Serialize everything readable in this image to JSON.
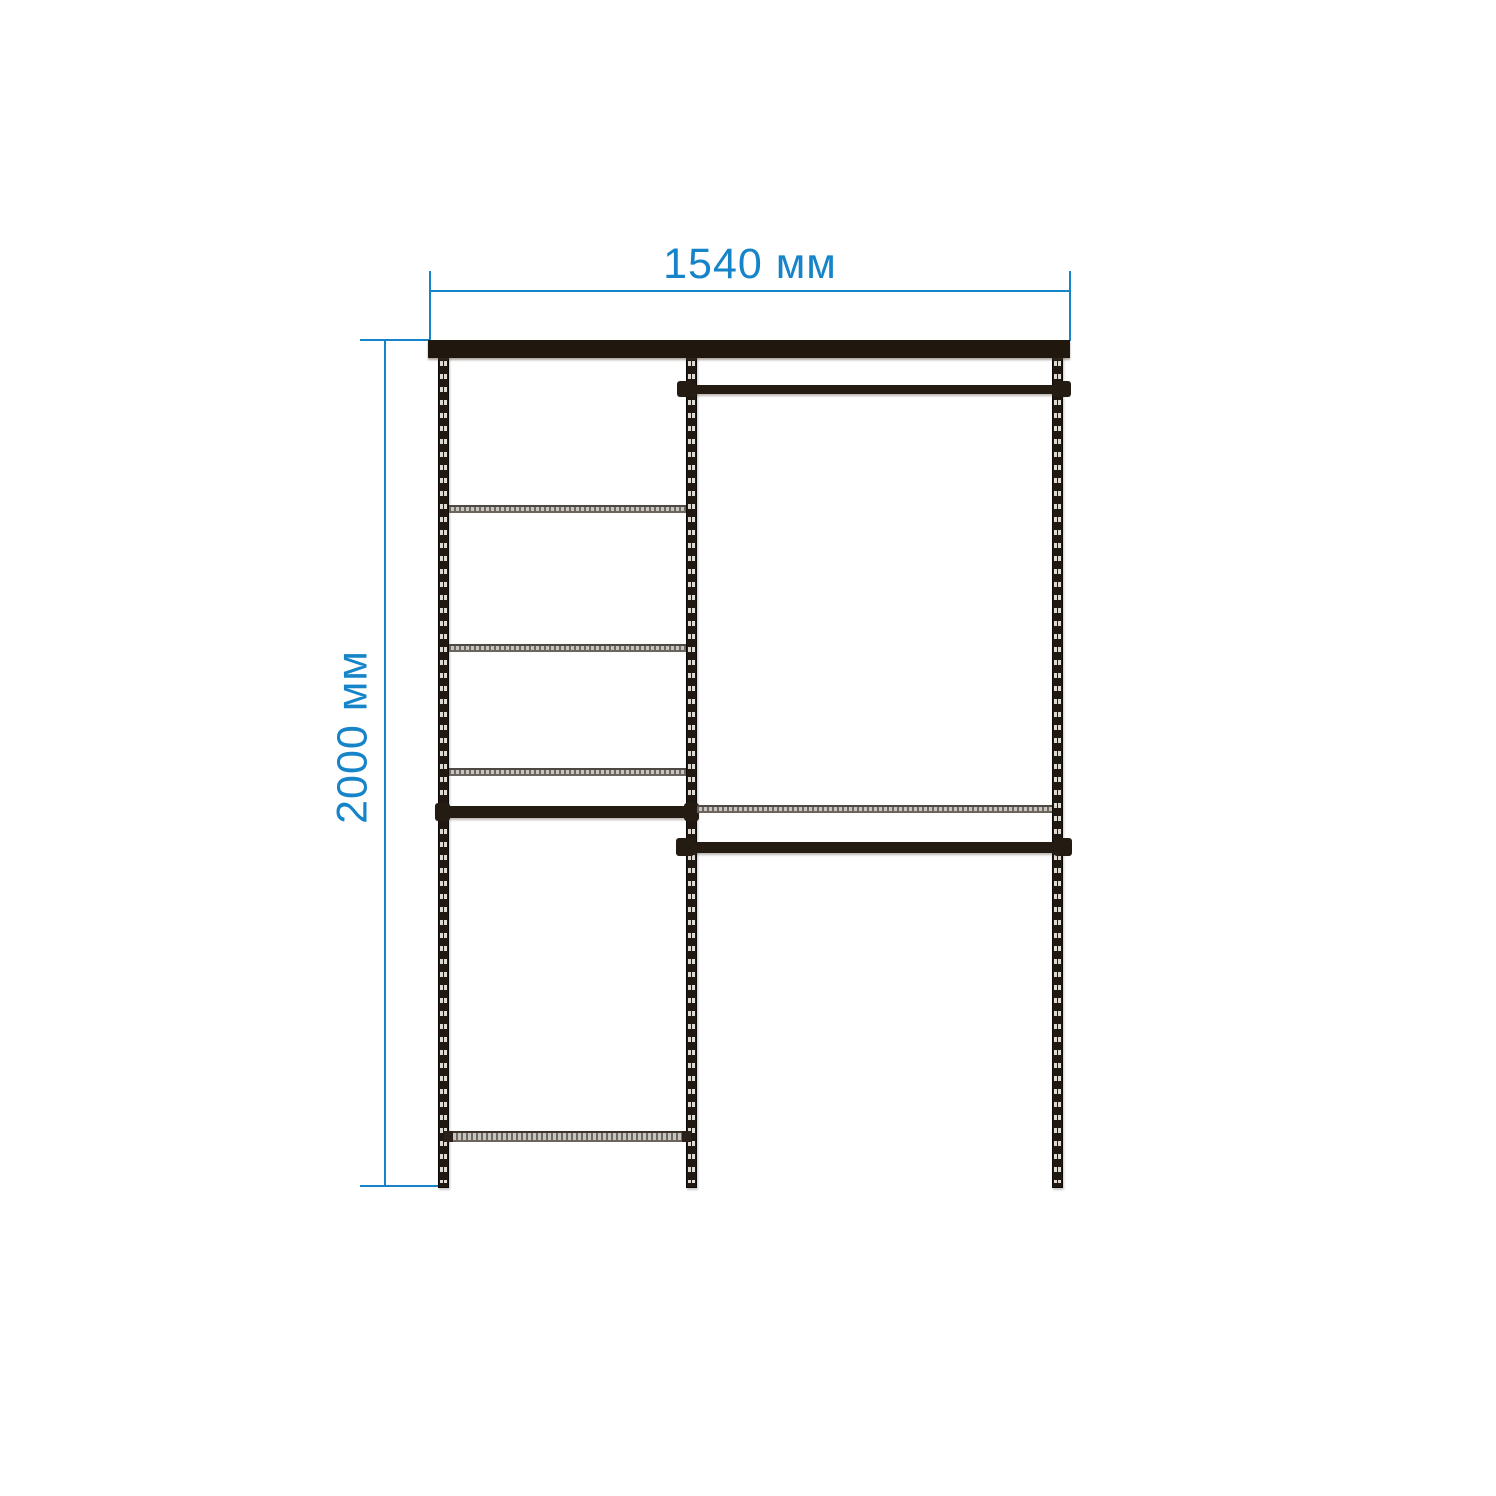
{
  "dimensions": {
    "width": {
      "label": "1540 мм"
    },
    "height": {
      "label": "2000 мм"
    }
  },
  "colors": {
    "dimension_blue": "#1684c9",
    "frame_dark": "#20180f",
    "shelf_grey": "#c7c4bf",
    "background": "#ffffff"
  }
}
